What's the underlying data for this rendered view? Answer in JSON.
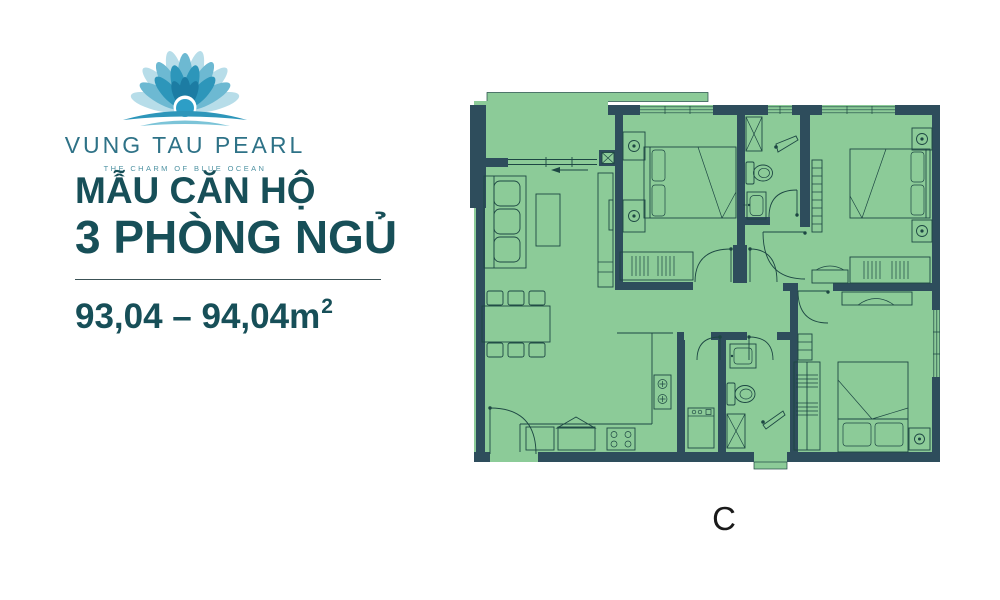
{
  "brand": {
    "name": "VUNG TAU PEARL",
    "tagline": "THE CHARM OF BLUE OCEAN",
    "logo_icon": "lotus-flower-icon"
  },
  "apartment": {
    "title_line1": "MẪU CĂN HỘ",
    "title_line2": "3 PHÒNG NGỦ",
    "area_range": "93,04 – 94,04m",
    "area_exponent": "2"
  },
  "floorplan": {
    "unit_label": "C"
  },
  "colors": {
    "wall": "#2e4d5c",
    "floor": "#8ccb98",
    "furniture_line": "#1d4743",
    "title_text": "#174f58",
    "brand_text": "#2e7287",
    "tagline_text": "#4f93a3",
    "unit_label_text": "#1a1a1a"
  }
}
